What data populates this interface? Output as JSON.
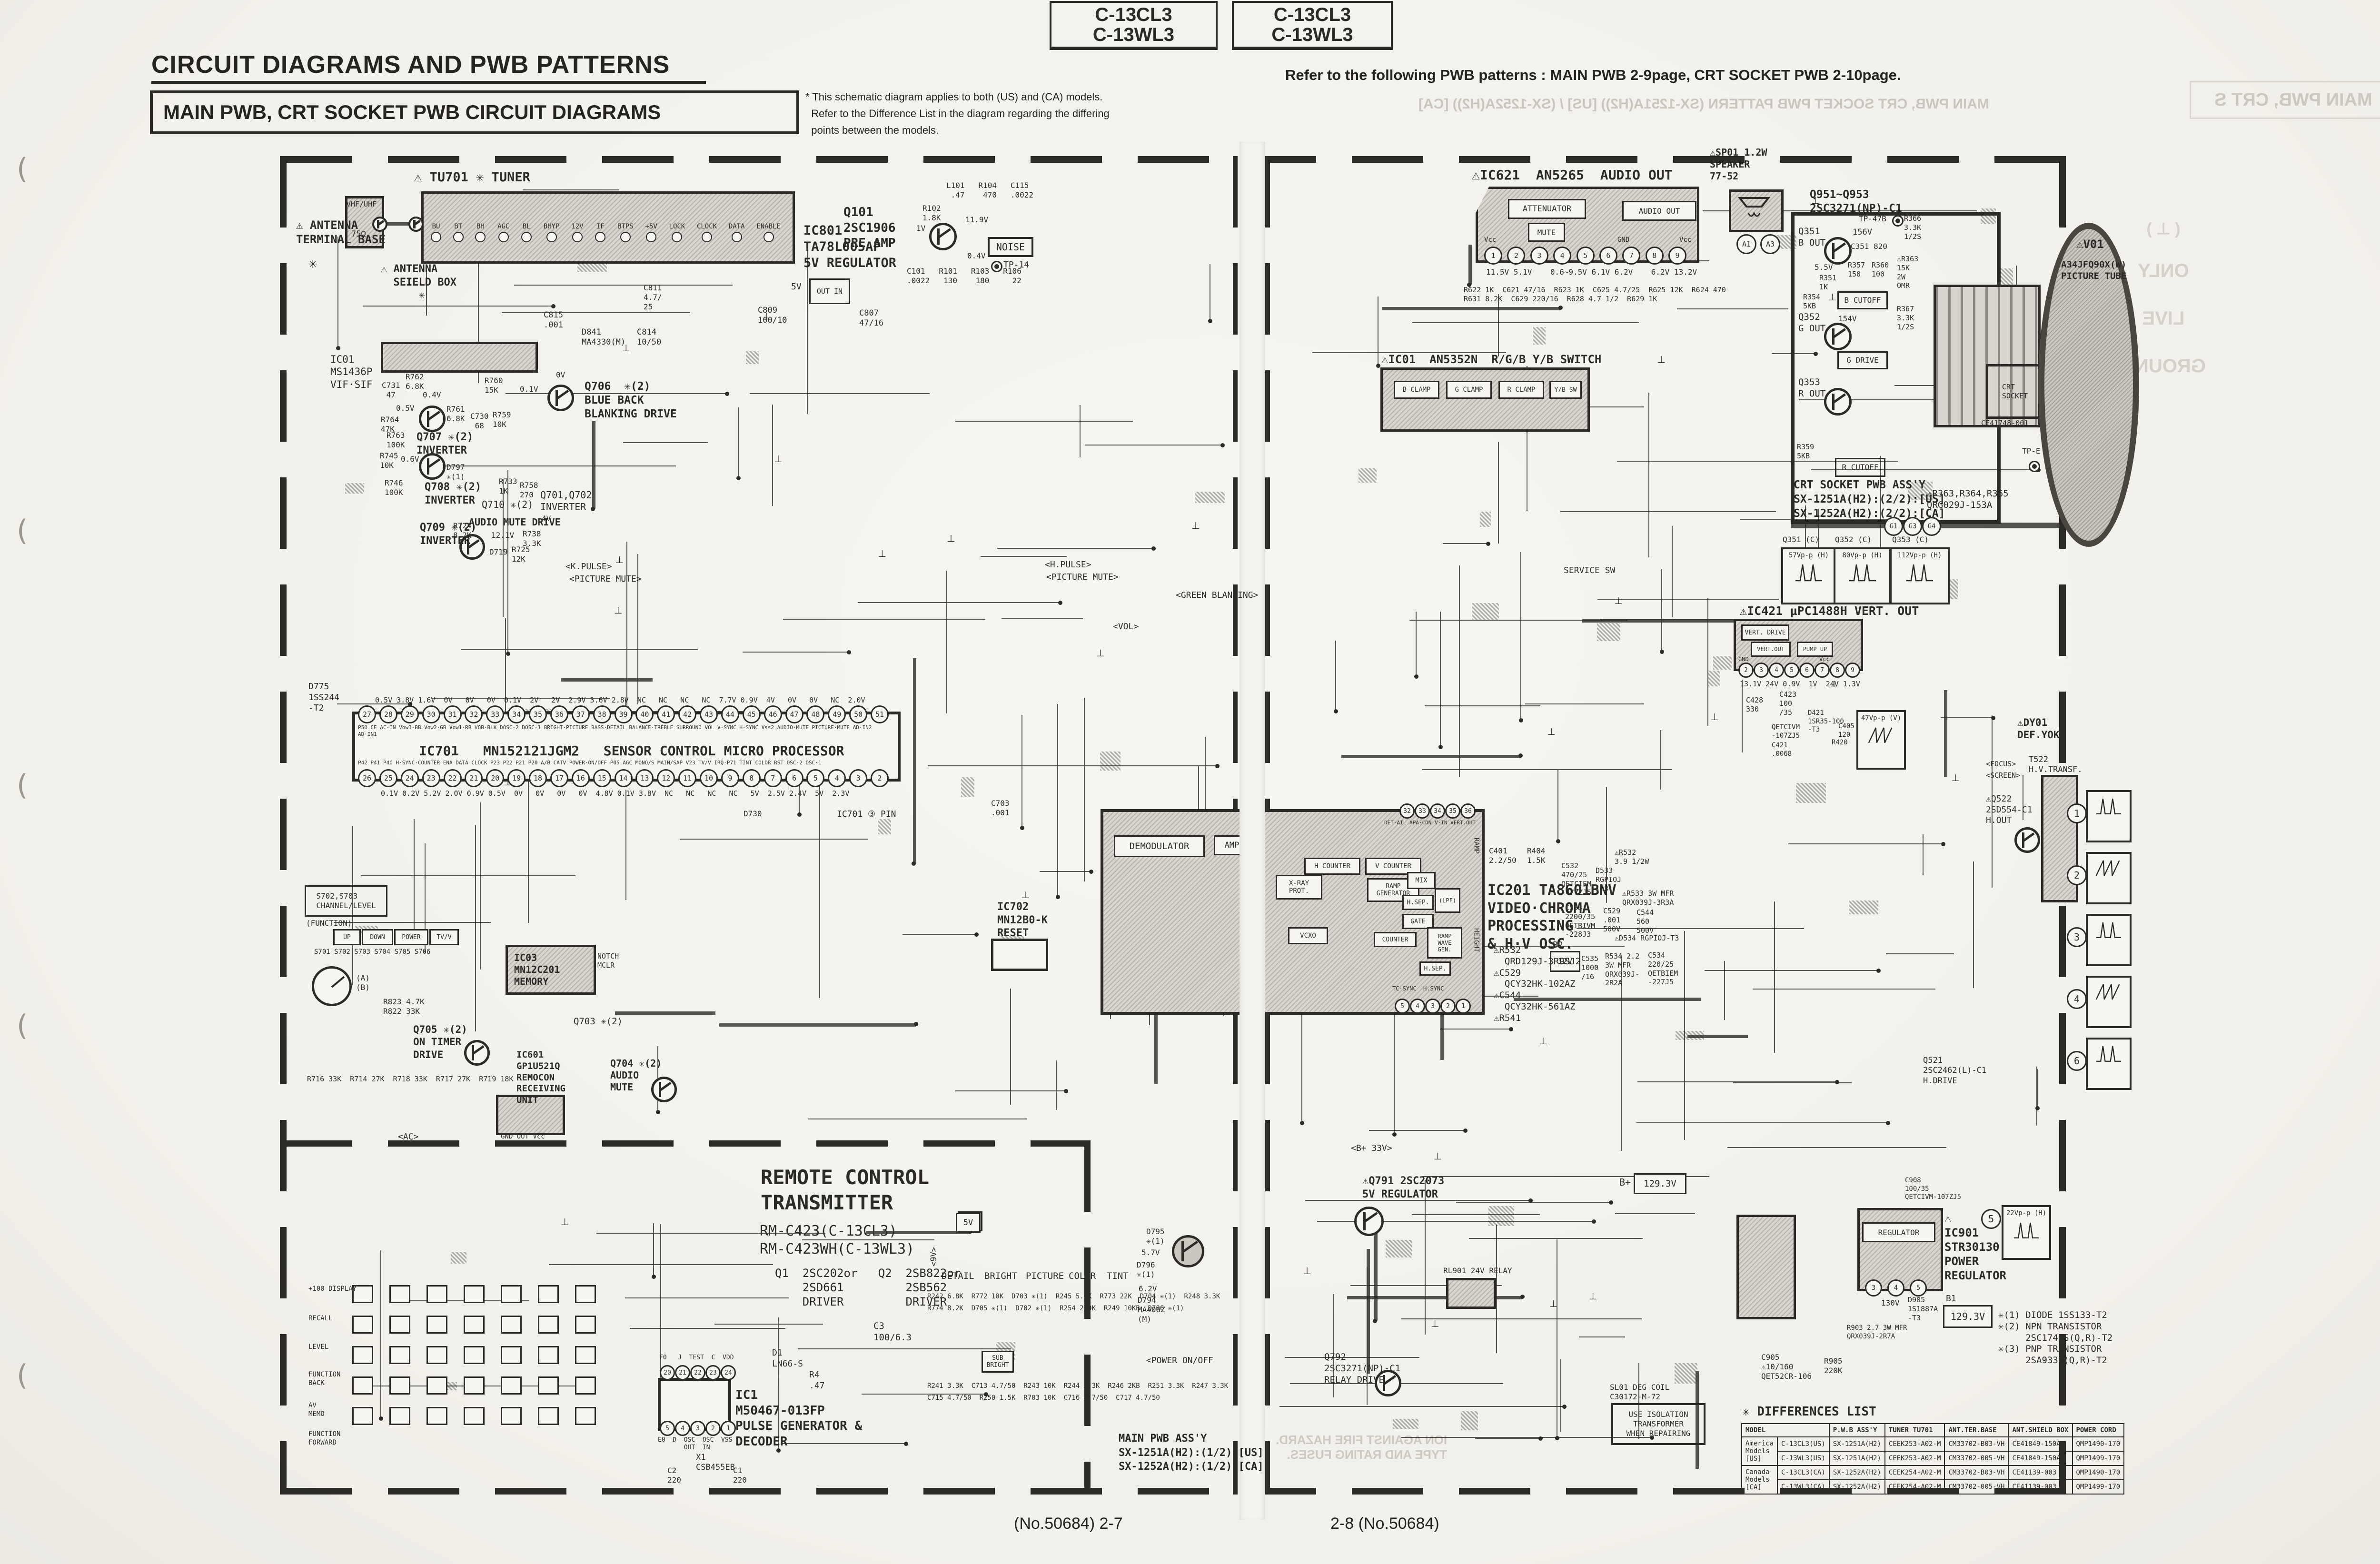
{
  "page": {
    "model_box": {
      "l1": "C-13CL3",
      "l2": "C-13WL3"
    },
    "title": "CIRCUIT DIAGRAMS AND PWB PATTERNS",
    "subtitle": "MAIN PWB, CRT SOCKET PWB CIRCUIT DIAGRAMS",
    "note": "* This schematic diagram applies to both (US) and (CA) models.\n  Refer to the Difference List in the diagram regarding the differing\n  points between the models.",
    "refer": "Refer to the following PWB patterns : MAIN PWB 2-9page, CRT SOCKET PWB 2-10page.",
    "footer_left": "(No.50684) 2-7",
    "footer_right": "2-8 (No.50684)"
  },
  "bleed": {
    "header": "MAIN PWB, CRT SOCKET PWB PATTERN (SX-1251A(H2)) [US] / (SX-1252A(H2)) [CA]",
    "box": "MAIN PWB, CRT S",
    "gsym": "( ⊥ )",
    "g1": "ONLY",
    "g2": "LIVE",
    "g3": "GROUND",
    "fire": "ION AGAINST FIRE HAZARD.\nTYPE AND RATING FUSES."
  },
  "tuner": {
    "label": "⚠ TU701 ✳ TUNER",
    "antenna": "⚠ ANTENNA\nTERMINAL BASE",
    "star": "✳",
    "vhf": "VHF/UHF",
    "ohm": "75Ω",
    "shield": "⚠ ANTENNA\n  SEIELD BOX\n      ✳",
    "pins": [
      "BU",
      "BT",
      "BH",
      "AGC",
      "BL",
      "BHYP",
      "12V",
      "IF",
      "BTPS",
      "+5V",
      "LOCK",
      "CLOCK",
      "DATA",
      "ENABLE"
    ]
  },
  "ic801": {
    "label": "IC801\nTA78L005AP\n5V REGULATOR",
    "reg": "OUT IN",
    "v5": "5V",
    "p1": "C809\n100/10",
    "p2": "C807\n47/16",
    "p3": "D841\nMA4330(M)",
    "p4": "C814\n10/50",
    "p5": "C815\n.001"
  },
  "q101": {
    "label": "Q101\n2SC1906\nPRE AMP",
    "noise": "NOISE",
    "tp": "TP-14",
    "p1": "L101   R104   C115\n .47    470   .0022",
    "p2": "R102\n1.8K",
    "p3": "11.9V",
    "p4": "0.4V",
    "p5": "C101   R101   R103   R106\n.0022   130    180     22",
    "p6": "1V",
    "c811": "C811\n4.7/\n25"
  },
  "vif": {
    "label": "IC01\nMS1436P\nVIF·SIF"
  },
  "bb": {
    "q706": "Q706  ✳(2)\nBLUE BACK\nBLANKING DRIVE",
    "q707": "Q707 ✳(2)\nINVERTER",
    "q708": "Q708 ✳(2)\nINVERTER",
    "q709": "Q709 ✳(2)\nINVERTER",
    "q710": "Q710 ✳(2)",
    "q701": "Q701,Q702\nINVERTER",
    "amd": "AUDIO MUTE DRIVE",
    "p1": "C731\n 47",
    "p2": "R764\n47K",
    "p3": "R762\n6.8K",
    "p4": "R760\n15K",
    "p5": "R761\n6.8K",
    "p6": "C730\n 68",
    "p7": "R759\n10K",
    "p8": "R763\n100K",
    "p9": "R745\n10K",
    "p10": "R746\n100K",
    "p11": "D797\n✳(1)",
    "p12": "R733\n1K",
    "p13": "R758\n270",
    "p14": "R724\n8.2K",
    "p15": "R738\n3.3K",
    "p16": "D719",
    "p17": "R725\n12K",
    "v1": "0.4V",
    "v2": "0.5V",
    "v3": "0.1V",
    "v4": "0V",
    "v5": "0.6V",
    "v6": "12.1V",
    "v7": "4V"
  },
  "ic701": {
    "d775": "D775\n1SS244\n-T2",
    "vt": "0.5V 3.8V 1.6V  0V   0V   0V  0.1V  2V   2V  2.9V 3.6V 2.8V  NC   NC   NC   NC  7.7V 0.9V  4V   0V   0V   NC  2.0V",
    "pins_top": [
      "27",
      "28",
      "29",
      "30",
      "31",
      "32",
      "33",
      "34",
      "35",
      "36",
      "37",
      "38",
      "39",
      "40",
      "41",
      "42",
      "43",
      "44",
      "45",
      "46",
      "47",
      "48",
      "49",
      "50",
      "51"
    ],
    "lbl_top": "P50  CE  AC·IN Vow3·BB Vow2·GB Vow1·RB VOB·BLK DOSC·2 DOSC·1  BRIGHT·PICTURE  BASS·DETAIL  BALANCE·TREBLE  SURROUND  VOL  V·SYNC  H·SYNC  Vss2  AUDIO·MUTE  PICTURE·MUTE  AD·IN2 AD·IN1",
    "name": "IC701   MN152121JGM2   SENSOR CONTROL MICRO PROCESSOR",
    "lbl_bot": "P42 P41 P40 H·SYNC·COUNTER ENA DATA CLOCK P23 P22 P21 P20 A/B CATV POWER·ON/OFF P05 AGC MONO/S MAIN/SAP V23 TV/V IRQ·P71 TINT COLOR RST OSC·2 OSC·1",
    "pins_bot": [
      "26",
      "25",
      "24",
      "23",
      "22",
      "21",
      "20",
      "19",
      "18",
      "17",
      "16",
      "15",
      "14",
      "13",
      "12",
      "11",
      "10",
      "9",
      "8",
      "7",
      "6",
      "5",
      "4",
      "3",
      "2"
    ],
    "vb": "0.1V 0.2V 5.2V 2.0V 0.9V 0.5V  0V   0V   0V   0V  4.8V 0.1V 3.8V  NC   NC   NC   NC   5V  2.5V 2.4V  5V  2.3V",
    "pin3": "IC701 ③ PIN",
    "c703": "C703\n.001",
    "d730": "D730"
  },
  "ic702": {
    "label": "IC702\nMN12B0-K\nRESET"
  },
  "ic03": {
    "label": "IC03\nMN12C201\nMEMORY",
    "notch": "NOTCH\nMCLR"
  },
  "sw": {
    "s": "S702,S703\nCHANNEL/LEVEL",
    "fn": "(FUNCTION)",
    "b1": "UP",
    "b2": "DOWN",
    "b3": "POWER",
    "b4": "TV/V",
    "srow": "S701 S702 S703 S704 S705 S706",
    "ab": "(A)\n(B)",
    "res": "R716 33K  R714 27K  R718 33K  R717 27K  R719 18K"
  },
  "q705": {
    "label": "Q705 ✳(2)\nON TIMER\nDRIVE",
    "q703": "Q703 ✳(2)",
    "r": "R823 4.7K\nR822 33K"
  },
  "ic601": {
    "label": "IC601\nGP1U521Q\nREMOCON\nRECEIVING\nUNIT",
    "pins": "GND OUT Vcc"
  },
  "q704": {
    "label": "Q704 ✳(2)\nAUDIO\nMUTE"
  },
  "sig": {
    "k": "<K.PULSE>",
    "pm": "<PICTURE MUTE>",
    "h": "<H.PULSE>",
    "pm2": "<PICTURE MUTE>",
    "gb": "<GREEN BLANKING>",
    "vol": "<VOL>",
    "ac": "<AC>",
    "b33": "<B+ 33V>",
    "pwr": "<POWER ON/OFF",
    "svc": "SERVICE SW"
  },
  "remote": {
    "title": "REMOTE CONTROL\nTRANSMITTER",
    "models": "RM-C423(C-13CL3)\nRM-C423WH(C-13WL3)",
    "drv": "Q1  2SC202or   Q2  2SB822or\n    2SD661         2SB562\n    DRIVER         DRIVER",
    "c3": "C3\n100/6.3",
    "ic1": "IC1\nM50467-013FP\nPULSE GENERATOR &\nDECODER",
    "x1": "X1\nCSB455EB",
    "c2": "C2\n220",
    "c1": "C1\n220",
    "d1": "D1\nLN66-S",
    "r4": "R4\n.47",
    "pt": [
      "20",
      "21",
      "22",
      "23",
      "24"
    ],
    "pt_l": "F0   J  TEST  C  VDD",
    "pb": [
      "5",
      "4",
      "3",
      "2",
      "1"
    ],
    "pb_l": "E0  D  OSC  OSC  VSS\n       OUT  IN",
    "k1": "+100 DISPLAY",
    "k2": "RECALL",
    "k3": "LEVEL",
    "k4": "FUNCTION\nBACK",
    "k5": "AV\nMEMO",
    "k6": "FUNCTION\nFORWARD",
    "v5": "5V",
    "v9": "<9V>"
  },
  "ic201": {
    "label": "IC201 TA8601BNV\nVIDEO·CHROMA\nPROCESSING\n& H·V OSC.",
    "demod": "DEMODULATOR",
    "amp": "AMP",
    "xray": "X-RAY\nPROT.",
    "hcnt": "H COUNTER",
    "vcnt": "V COUNTER",
    "rampg": "RAMP\nGENERATOR",
    "vcxo": "VCXO",
    "mix": "MIX",
    "hsep": "H.SEP.",
    "gate": "GATE",
    "lpf": "(LPF)",
    "rwg": "RAMP\nWAVE\nGEN.",
    "cnt": "COUNTER",
    "hsep2": "H.SEP.",
    "pins_t": [
      "32",
      "33",
      "34",
      "35",
      "36"
    ],
    "pt_l": "DET·AIL APA·CON V·IN VERT.OUT",
    "pins_b": [
      "5",
      "4",
      "3",
      "2",
      "1"
    ],
    "pb_l": "TC·SYNC  H.SYNC",
    "ramp": "RAMP",
    "height": "HEIGHT",
    "warn": "⚠R532\n  QRD129J-3R9SJ2\n⚠C529\n  QCY32HK-102AZ\n⚠C544\n  QCY32HK-561AZ\n⚠R541",
    "c401": "C401\n2.2/50",
    "r404": "R404\n1.5K"
  },
  "psnub": {
    "b2": "B2",
    "v12": "12V",
    "p1": "C535\n1000\n/16",
    "p2": "R534 2.2\n3W MFR\nQRX039J-\n2R2A",
    "p3": "C534\n220/25\nQETBIEM\n-227J5",
    "p4": "⚠D534 RGPIOJ-T3",
    "p5": "C533\n2200/35\nQETBIVM\n-228J3",
    "p6": "C529\n.001\n500V",
    "p7": "C544\n560\n500V",
    "p8": "⚠R533 3W MFR\nQRX039J-3R3A",
    "p9": "D533\nRGPIOJ\n-T3",
    "p10": "C532\n470/25\nQETCIEM\n-477ZJ5",
    "p11": "⚠R532\n3.9 1/2W"
  },
  "rgbsw": {
    "label": "⚠IC01  AN5352N  R/G/B Y/B SWITCH",
    "b": "B CLAMP",
    "g": "G CLAMP",
    "r": "R CLAMP",
    "yb": "Y/B SW"
  },
  "ic621": {
    "label": "⚠IC621  AN5265  AUDIO OUT",
    "att": "ATTENUATOR",
    "mute": "MUTE",
    "aout": "AUDIO OUT",
    "pins": [
      "1",
      "2",
      "3",
      "4",
      "5",
      "6",
      "7",
      "8",
      "9"
    ],
    "vcc1": "Vcc",
    "gnd": "GND",
    "vcc2": "Vcc",
    "volts": "11.5V 5.1V    0.6~9.5V 6.1V 6.2V    6.2V 13.2V",
    "parts": "R622 1K  C621 47/16  R623 1K  C625 4.7/25  R625 12K  R624 470\nR631 8.2K  C629 220/16  R628 4.7 1/2  R629 1K",
    "spk": "⚠SP01 1.2W\nSPEAKER\n77-52",
    "a1": "A1",
    "a3": "A3"
  },
  "crt": {
    "q": "Q951~Q953\n2SC3271(NP)-C1",
    "q351": "Q351\nB OUT",
    "q352": "Q352\nG OUT",
    "q353": "Q353\nR OUT",
    "v156": "156V",
    "v154": "154V",
    "c351": "C351 820",
    "v55": "5.5V",
    "r351": "R351\n1K",
    "r354": "R354\n5KB",
    "r357": "R357\n150",
    "r360": "R360\n100",
    "r359": "R359\n5KB",
    "bcut": "B CUTOFF",
    "gdrv": "G DRIVE",
    "rcut": "R CUTOFF",
    "tp47": "TP-47B",
    "r366": "R366\n3.3K\n1/2S",
    "r363": "⚠R363\n15K\n2W\nOMR",
    "r367": "R367\n3.3K\n1/2S",
    "sock": "CRT\nSOCKET",
    "ce": "CE41748-001",
    "assy": "CRT SOCKET PWB ASS'Y\nSX-1251A(H2):(2/2):[US]\nSX-1252A(H2):(2/2):[CA]",
    "warn": "⚠R363,R364,R365\nQRG029J-153A",
    "grid": [
      "G1",
      "G3",
      "G4"
    ],
    "tpe": "TP-E",
    "w1t": "Q351 (C)",
    "w2t": "Q352 (C)",
    "w3t": "Q353 (C)",
    "w1": "57Vp-p (H)",
    "w2": "80Vp-p (H)",
    "w3": "112Vp-p (H)"
  },
  "tube": {
    "v01": "⚠V01",
    "name": "A34JFQ90X(W)\nPICTURE TUBE"
  },
  "vert": {
    "label": "⚠IC421 µPC1488H VERT. OUT",
    "vd": "VERT. DRIVE",
    "vo": "VERT.OUT",
    "pu": "PUMP UP",
    "pins": [
      "2",
      "3",
      "4",
      "5",
      "6",
      "7",
      "8",
      "9"
    ],
    "gnd": "GND",
    "vcc": "Vcc",
    "volts": "13.1V 24V 0.9V  1V  24V 1.3V",
    "p1": "C428\n330",
    "p2": "C423\n100\n/35",
    "p3": "QETCIVM\n-107ZJ5",
    "p4": "C421\n.0068",
    "p5": "D421\n1SR35-100\n-T3",
    "p6": "R420",
    "p7": "C405\n120",
    "wv": "47Vp-p (V)",
    "dy": "⚠DY01\nDEF.YOKE",
    "q522": "⚠Q522\n2SD554-C1\nH.OUT",
    "q521": "Q521\n2SC2462(L)-C1\nH.DRIVE",
    "t522": "T522\nH.V.TRANSF.",
    "focus": "<FOCUS>",
    "screen": "<SCREEN>"
  },
  "pwr": {
    "ic": "⚠\nIC901\nSTR30130\nPOWER\nREGULATOR",
    "reg": "REGULATOR",
    "pins": [
      "3",
      "4",
      "5"
    ],
    "v130": "130V",
    "d905": "D905\n1S1887A\n-T3",
    "r903": "R903 2.7 3W MFR\nQRX039J-2R7A",
    "b1": "B1",
    "b1v": "129.3V",
    "c908": "C908\n100/35\nQETCIVM-107ZJ5",
    "w5": "22Vp-p (H)",
    "n5": "5",
    "q791": "⚠Q791 2SC2073\n5V REGULATOR",
    "q792": "Q792\n2SC3271(NP)-C1\nRELAY DRIVE",
    "rl": "RL901 24V RELAY",
    "bp": "B+",
    "bpv": "129.3V",
    "sl": "SL01 DEG COIL\nC30172-M-72",
    "iso": "USE ISOLATION\nTRANSFORMER\nWHEN REPAIRING",
    "c905": "C905\n⚠10/160\nQET52CR-106",
    "r905": "R905\n220K",
    "d795": "D795\n✳(1)",
    "v57": "5.7V",
    "d796": "D796\n✳(1)",
    "v62": "6.2V",
    "d794": "D794\nMA406Z\n(M)"
  },
  "legend": {
    "t": "✳(1) DIODE 1SS133-T2\n✳(2) NPN TRANSISTOR\n     2SC1740S(Q,R)-T2\n✳(3) PNP TRANSISTOR\n     2SA933S(Q,R)-T2"
  },
  "ctl": {
    "v5": "5V",
    "l1": "DETAIL",
    "l2": "BRIGHT",
    "l3": "PICTURE",
    "l4": "COLOR",
    "l5": "TINT",
    "sub": "SUB\nBRIGHT",
    "row1": "R242 6.8K  R772 10K  D703 ✳(1)  R245 5.6K  R773 22K  D704 ✳(1)  R248 3.3K\nR774 8.2K  D705 ✳(1)  D702 ✳(1)  R254 270K  R249 10KB  D706 ✳(1)",
    "row2": "R241 3.3K  C713 4.7/50  R243 10K  R244 3.3K  R246 2KB  R251 3.3K  R247 3.3K\nC715 4.7/50  R250 1.5K  R703 10K  C716 4.7/50  C717 4.7/50"
  },
  "mainassy": {
    "t": "MAIN PWB ASS'Y\nSX-1251A(H2):(1/2):[US]\nSX-1252A(H2):(1/2):[CA]"
  },
  "wavecol": {
    "nums": [
      "1",
      "2",
      "3",
      "4",
      "6"
    ]
  },
  "diff": {
    "title": "✳ DIFFERENCES LIST",
    "h0": "MODEL",
    "h1": "P.W.B ASS'Y",
    "h2": "TUNER TU701",
    "h3": "ANT.TER.BASE",
    "h4": "ANT.SHIELD BOX",
    "h5": "POWER CORD",
    "g0": "America\nModels\n[US]",
    "g1": "Canada\nModels\n[CA]",
    "rows": [
      [
        "C-13CL3(US)",
        "SX-1251A(H2)",
        "CEEK253-A02-M",
        "CM33702-B03-VH",
        "CE41849-150A",
        "QMP1490-170"
      ],
      [
        "C-13WL3(US)",
        "SX-1251A(H2)",
        "CEEK253-A02-M",
        "CM33702-005-VH",
        "CE41849-150A",
        "QMP1499-170"
      ],
      [
        "C-13CL3(CA)",
        "SX-1252A(H2)",
        "CEEK254-A02-M",
        "CM33702-B03-VH",
        "CE41139-003",
        "QMP1490-170"
      ],
      [
        "C-13WL3(CA)",
        "SX-1252A(H2)",
        "CEEK254-A02-M",
        "CM33702-005-VH",
        "CE41139-003",
        "QMP1499-170"
      ]
    ]
  }
}
